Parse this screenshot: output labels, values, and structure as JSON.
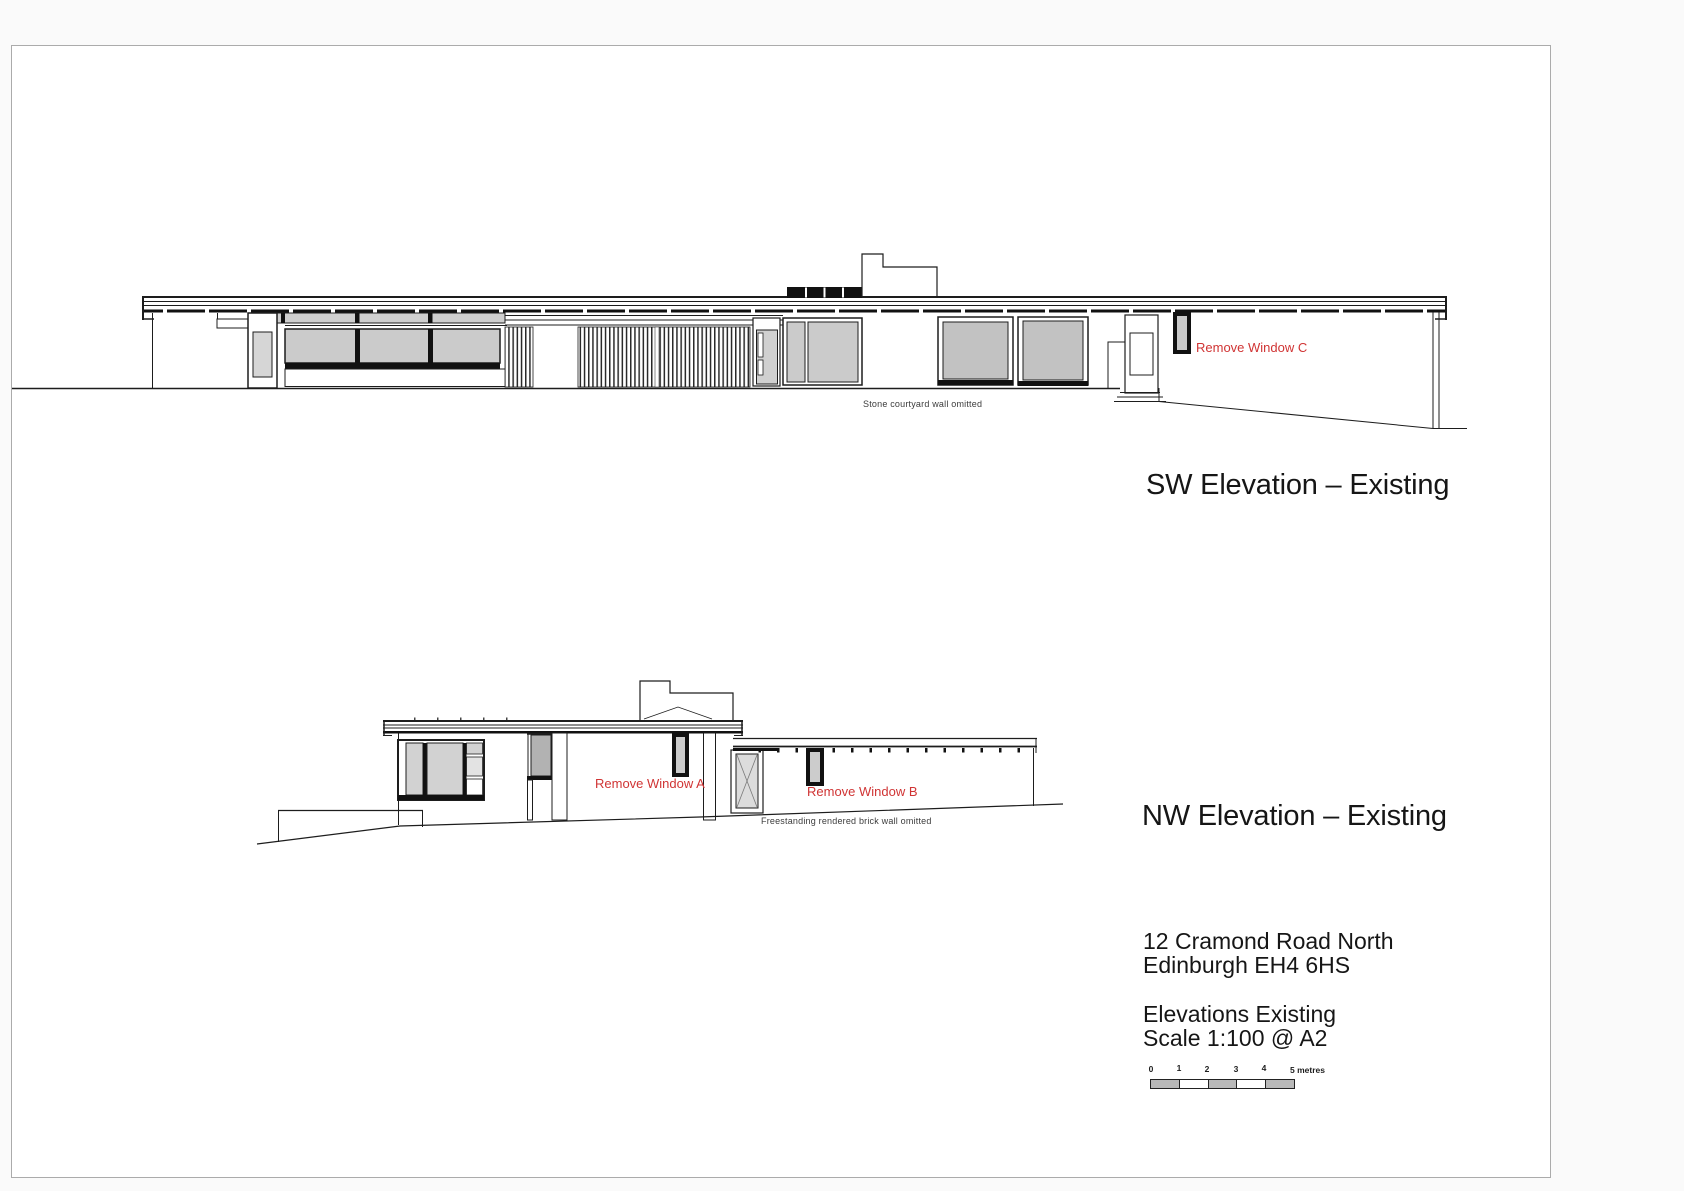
{
  "page": {
    "background_color": "#fafafa",
    "paper_color": "#ffffff",
    "border_color": "#ababab"
  },
  "colors": {
    "line": "#1d1d1d",
    "annotation_red": "#d03434",
    "glass_light": "#d2d2d2",
    "glass_mid": "#c9c9c9",
    "glass_dark": "#b2b2b2"
  },
  "sw_elevation": {
    "title": "SW Elevation – Existing",
    "note": "Stone courtyard wall omitted",
    "annotations": {
      "window_c": "Remove Window C"
    }
  },
  "nw_elevation": {
    "title": "NW Elevation – Existing",
    "note": "Freestanding rendered brick wall omitted",
    "annotations": {
      "window_a": "Remove Window A",
      "window_b": "Remove Window B"
    }
  },
  "title_block": {
    "address_line1": "12 Cramond Road North",
    "address_line2": "Edinburgh EH4 6HS",
    "drawing_title": "Elevations Existing",
    "scale": "Scale 1:100 @ A2"
  },
  "scale_bar": {
    "tick_labels": [
      "0",
      "1",
      "2",
      "3",
      "4"
    ],
    "end_label": "5 metres"
  }
}
